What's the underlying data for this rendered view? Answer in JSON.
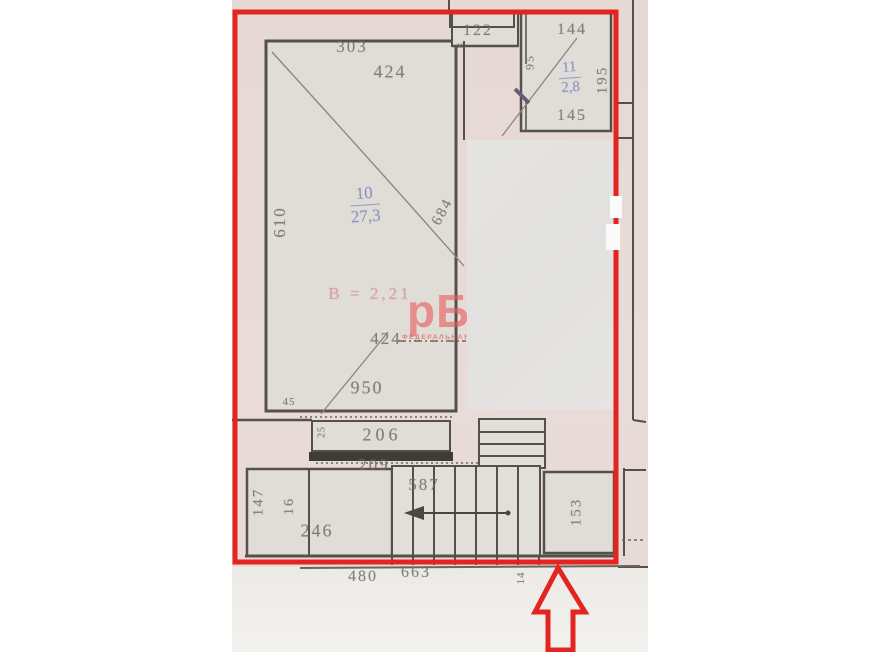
{
  "plan": {
    "labels": {
      "dim303": "303",
      "dim424top": "424",
      "dim122": "122",
      "tiny_m": "м",
      "dim144": "144",
      "room11_num": "11",
      "room11_area": "2,8",
      "dim145": "145",
      "dim195": "195",
      "dim95": "95",
      "dim610": "610",
      "room10_num": "10",
      "room10_area": "27,3",
      "height_note": "В = 2,21",
      "diag684": "684",
      "dim424mid": "424",
      "dim950": "950",
      "dim45": "45",
      "dim25": "25",
      "dim206": "206",
      "dim209": "209",
      "dim147": "147",
      "dim16": "16",
      "dim246": "246",
      "dim587": "587",
      "dim153": "153",
      "dim14": "14",
      "dim480": "480",
      "dim663": "663"
    },
    "watermark": {
      "big": "рБН",
      "small": "ФЕДЕРАЛЬНАЯ СЕТЬ"
    },
    "colors": {
      "annotation_red": "#e32421",
      "blue_text": "#7f87c4",
      "pink_text": "#e0919f",
      "watermark_red": "#e75c5c",
      "wall_line": "#55504a",
      "paper_pink": "#e9dbd8",
      "room_fill": "#e0ddd6"
    }
  }
}
